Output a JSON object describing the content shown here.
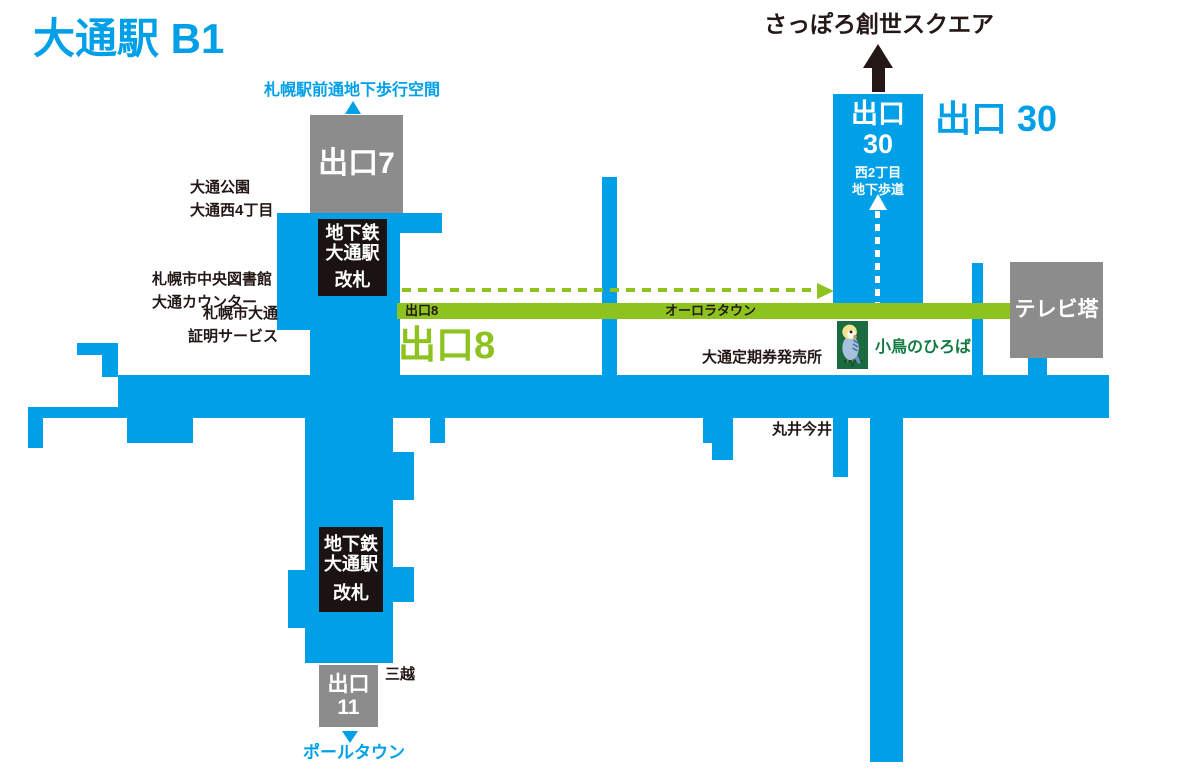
{
  "title": "大通駅 B1",
  "colors": {
    "corridor_blue": "#00A0E9",
    "aurora_green": "#8DC21F",
    "kotori_box_green": "#1B6B40",
    "kotori_text_green": "#117A40",
    "exit_gray": "#8C8C8C",
    "gate_black": "#1A1311",
    "text_black": "#231815",
    "white": "#FFFFFF"
  },
  "destinations": {
    "chikaho": "札幌駅前通地下歩行空間",
    "sosei_square": "さっぽろ創世スクエア",
    "pole_town": "ポールタウン"
  },
  "exits": {
    "exit7": "出口7",
    "exit8_tab": "出口8",
    "exit8_big": "出口8",
    "exit11_line1": "出口",
    "exit11_line2": "11",
    "exit30_box_line1": "出口",
    "exit30_box_line2": "30",
    "exit30_big": "出口 30"
  },
  "corridors": {
    "aurora_town": "オーロラタウン",
    "nishi2_line1": "西2丁目",
    "nishi2_line2": "地下歩道"
  },
  "gates": {
    "line1": "地下鉄",
    "line2": "大通駅",
    "line3": "改札"
  },
  "places": {
    "odori_park_line1": "大通公園",
    "odori_park_line2": "大通西4丁目",
    "library_line1": "札幌市中央図書館",
    "library_line2": "大通カウンター",
    "shomei_line1": "札幌市大通",
    "shomei_line2": "証明サービス",
    "teiki": "大通定期券発売所",
    "marui_imai": "丸井今井",
    "mitsukoshi": "三越",
    "tv_tower": "テレビ塔",
    "kotori_hiroba": "小鳥のひろば"
  }
}
